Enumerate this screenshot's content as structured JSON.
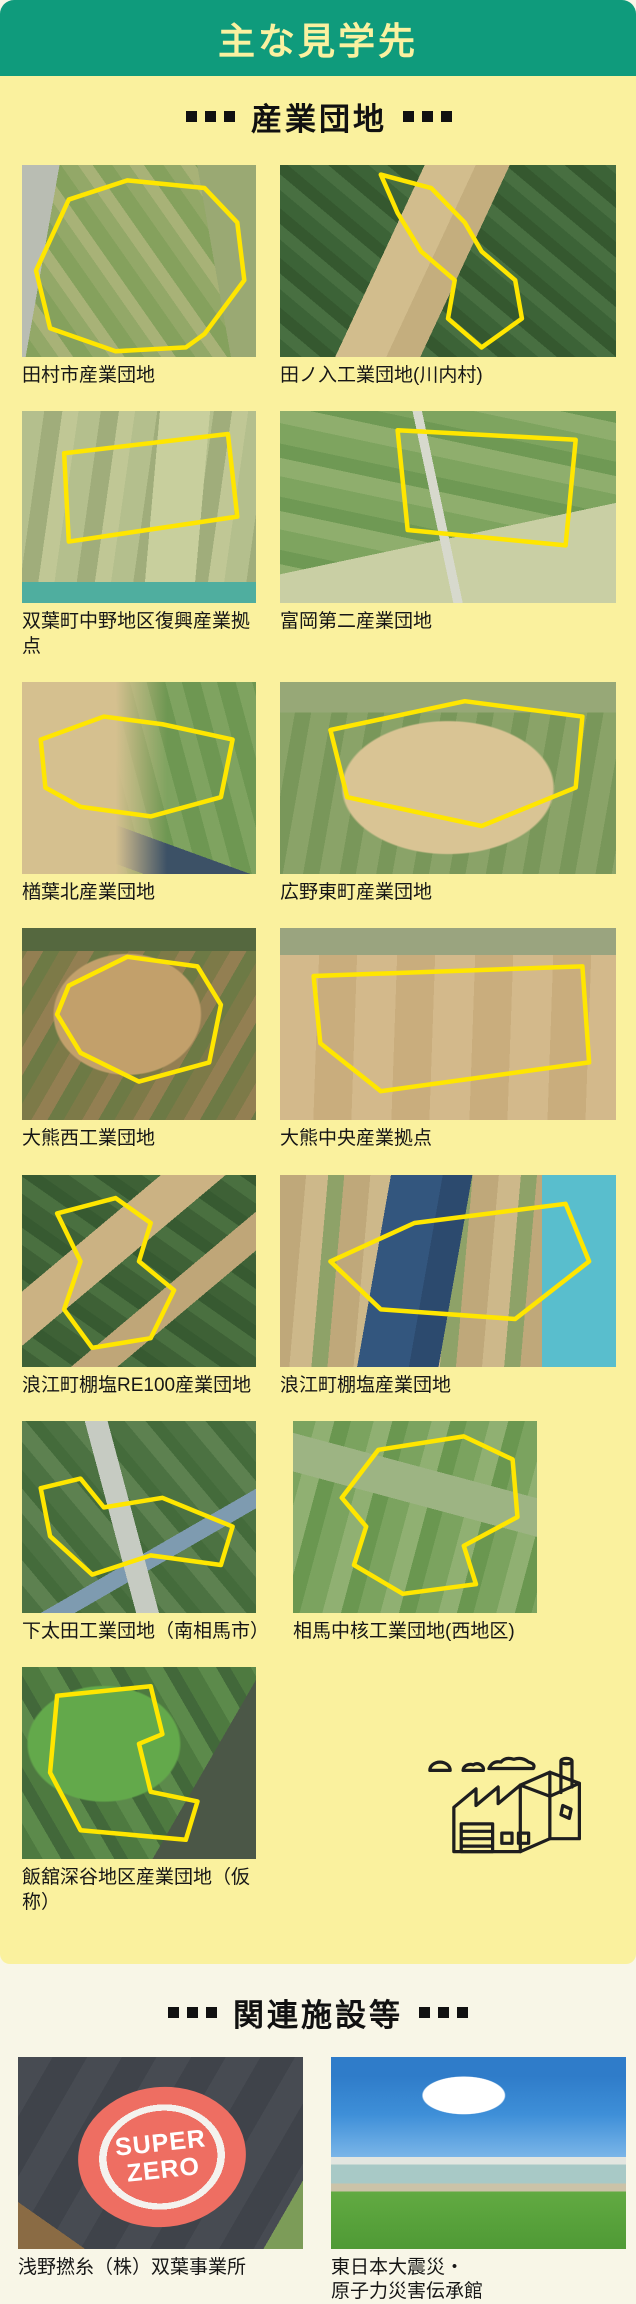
{
  "page": {
    "title": "主な見学先",
    "colors": {
      "header_green": "#0f9b7c",
      "card_yellow": "#faf19e",
      "page_ivory": "#f8f6e7",
      "outline_yellow": "#ffe600",
      "heading_text": "#111111",
      "title_text": "#faf1a0"
    }
  },
  "sections": [
    {
      "heading": "産業団地",
      "items": [
        {
          "label": "田村市産業団地"
        },
        {
          "label": "田ノ入工業団地(川内村)"
        },
        {
          "label": "双葉町中野地区復興産業拠点"
        },
        {
          "label": "富岡第二産業団地"
        },
        {
          "label": "楢葉北産業団地"
        },
        {
          "label": "広野東町産業団地"
        },
        {
          "label": "大熊西工業団地"
        },
        {
          "label": "大熊中央産業拠点"
        },
        {
          "label": "浪江町棚塩RE100産業団地"
        },
        {
          "label": "浪江町棚塩産業団地"
        },
        {
          "label": "下太田工業団地（南相馬市）"
        },
        {
          "label": "相馬中核工業団地(西地区)"
        },
        {
          "label": "飯舘深谷地区産業団地（仮称）"
        }
      ]
    },
    {
      "heading": "関連施設等",
      "items": [
        {
          "label": "浅野撚糸（株）双葉事業所",
          "photo_text": "SUPER ZERO"
        },
        {
          "label": "東日本大震災・\n原子力災害伝承館"
        }
      ]
    }
  ]
}
